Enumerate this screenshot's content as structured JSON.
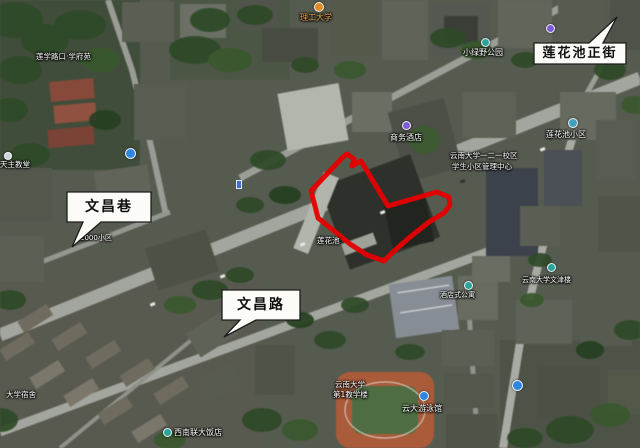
{
  "map": {
    "kind": "satellite-map",
    "highlight_outline_color": "#e60000",
    "road_color": "#a3a69e",
    "vegetation_color": "#2d4a26"
  },
  "street_callouts": [
    {
      "text": "莲花池正街"
    },
    {
      "text": "文昌巷"
    },
    {
      "text": "文昌路"
    }
  ],
  "poi_labels": [
    {
      "text": "莲学路口·学府苑"
    },
    {
      "text": "理工大学"
    },
    {
      "text": "小绿野公园"
    },
    {
      "text": "商务酒店"
    },
    {
      "text": "云南大学一二一校区"
    },
    {
      "text": "学生小区管理中心"
    },
    {
      "text": "莲花池小区"
    },
    {
      "text": "天主教堂"
    },
    {
      "text": "莲花池"
    },
    {
      "text": "酒店式公寓"
    },
    {
      "text": "云南大学文津楼"
    },
    {
      "text": "西南联大饭店"
    },
    {
      "text": "云南大学"
    },
    {
      "text": "第1教学楼"
    },
    {
      "text": "云大游泳馆"
    },
    {
      "text": "大学宿舍"
    },
    {
      "text": "2000小区"
    }
  ]
}
